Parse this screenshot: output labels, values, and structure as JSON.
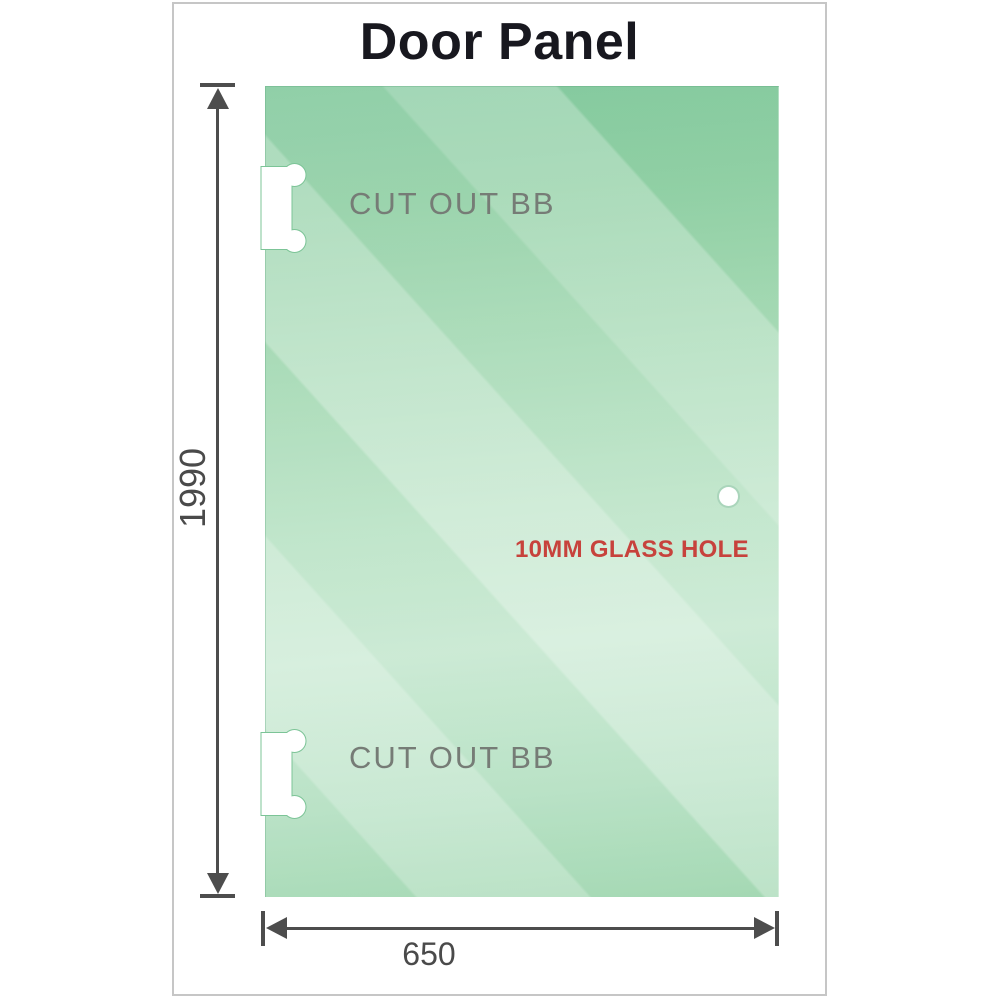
{
  "title": "Door Panel",
  "panel": {
    "material": "glass",
    "cutouts": [
      {
        "position": "top",
        "label": "CUT OUT BB"
      },
      {
        "position": "bottom",
        "label": "CUT OUT BB"
      }
    ],
    "hole_label": "10MM GLASS HOLE"
  },
  "dimensions": {
    "height": {
      "value": "1990",
      "orientation": "vertical"
    },
    "width": {
      "value": "650",
      "orientation": "horizontal"
    }
  },
  "colors": {
    "glass_green_dark": "#7ec79a",
    "glass_green_light": "#c6e8d0",
    "cutout_outline_green": "#7cc497",
    "dimension_gray": "#4d4d4d",
    "cutout_label_gray": "#767c76",
    "hole_label_red": "#c7423c",
    "title_color": "#18181f",
    "frame_border": "#c6c6c6"
  }
}
